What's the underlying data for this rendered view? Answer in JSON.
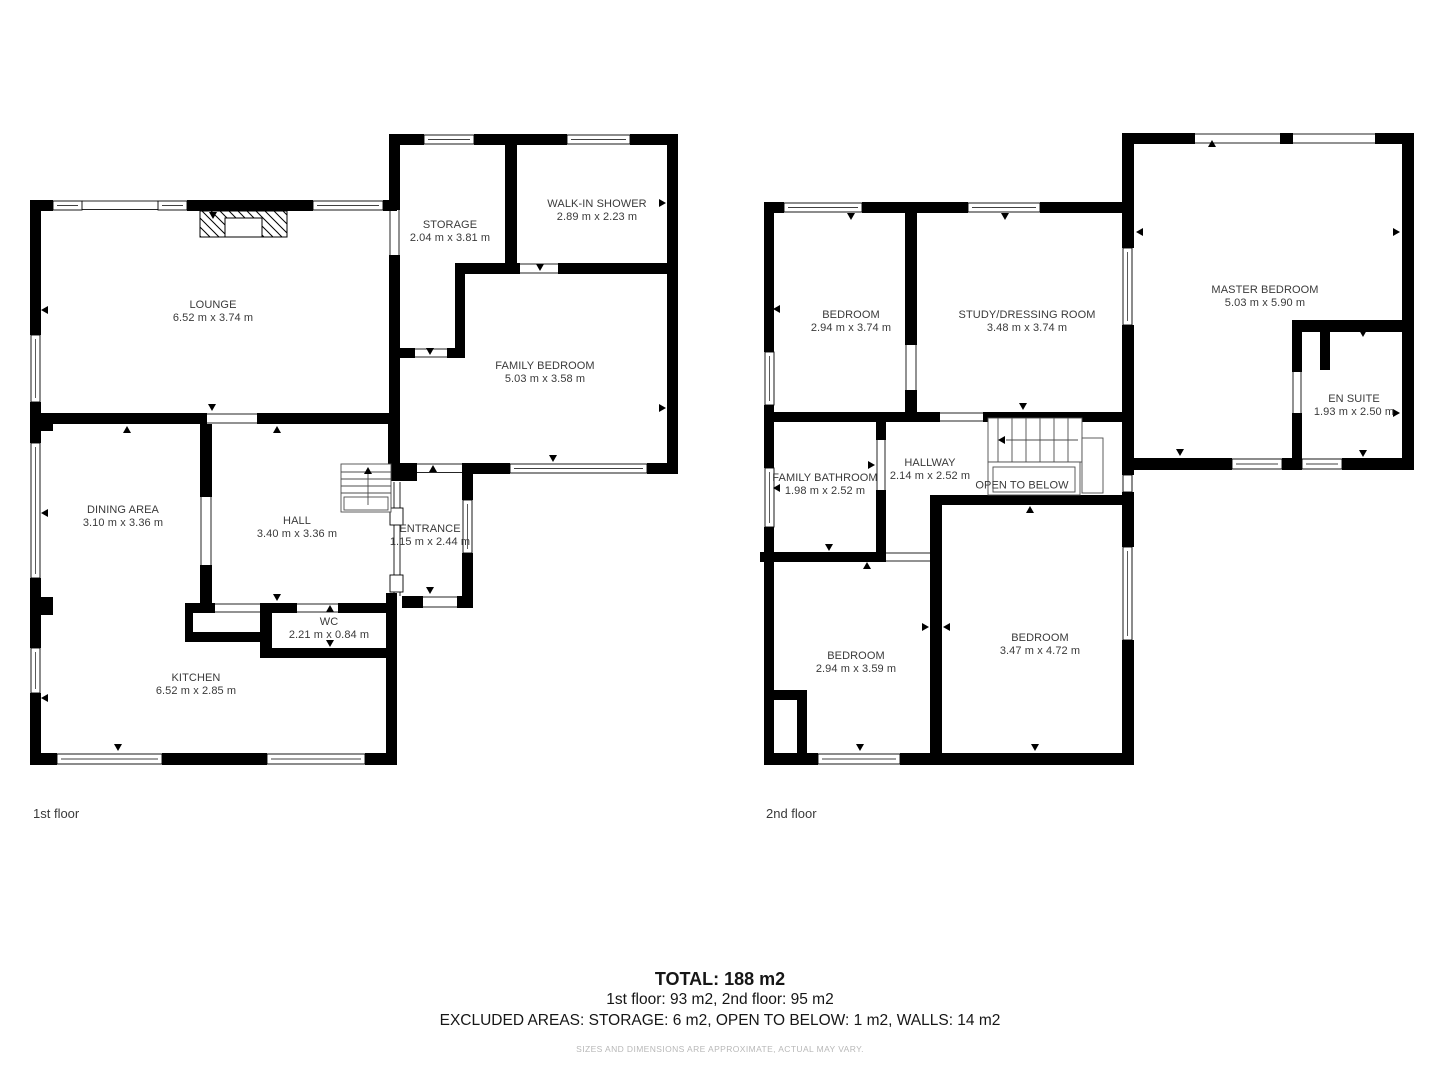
{
  "floors": [
    {
      "caption": "1st floor",
      "caption_x": 33,
      "caption_y": 806,
      "rooms": [
        {
          "name": "LOUNGE",
          "dims": "6.52 m x 3.74 m",
          "x": 213,
          "y": 312
        },
        {
          "name": "STORAGE",
          "dims": "2.04 m x 3.81 m",
          "x": 450,
          "y": 232
        },
        {
          "name": "WALK-IN SHOWER",
          "dims": "2.89 m x 2.23 m",
          "x": 597,
          "y": 211
        },
        {
          "name": "FAMILY BEDROOM",
          "dims": "5.03 m x 3.58 m",
          "x": 545,
          "y": 373
        },
        {
          "name": "DINING AREA",
          "dims": "3.10 m x 3.36 m",
          "x": 123,
          "y": 517
        },
        {
          "name": "HALL",
          "dims": "3.40 m x 3.36 m",
          "x": 297,
          "y": 528
        },
        {
          "name": "ENTRANCE",
          "dims": "1.15 m x 2.44 m",
          "x": 430,
          "y": 536
        },
        {
          "name": "WC",
          "dims": "2.21 m x 0.84 m",
          "x": 329,
          "y": 629
        },
        {
          "name": "KITCHEN",
          "dims": "6.52 m x 2.85 m",
          "x": 196,
          "y": 685
        }
      ]
    },
    {
      "caption": "2nd floor",
      "caption_x": 766,
      "caption_y": 806,
      "rooms": [
        {
          "name": "BEDROOM",
          "dims": "2.94 m x 3.74 m",
          "x": 851,
          "y": 322
        },
        {
          "name": "STUDY/DRESSING ROOM",
          "dims": "3.48 m x 3.74 m",
          "x": 1027,
          "y": 322
        },
        {
          "name": "MASTER BEDROOM",
          "dims": "5.03 m x 5.90 m",
          "x": 1265,
          "y": 297
        },
        {
          "name": "EN SUITE",
          "dims": "1.93 m x 2.50 m",
          "x": 1354,
          "y": 406
        },
        {
          "name": "FAMILY BATHROOM",
          "dims": "1.98 m x 2.52 m",
          "x": 825,
          "y": 485
        },
        {
          "name": "HALLWAY",
          "dims": "2.14 m x 2.52 m",
          "x": 930,
          "y": 470
        },
        {
          "name": "OPEN TO BELOW",
          "dims": "",
          "x": 1022,
          "y": 486
        },
        {
          "name": "BEDROOM",
          "dims": "2.94 m x 3.59 m",
          "x": 856,
          "y": 663
        },
        {
          "name": "BEDROOM",
          "dims": "3.47 m x 4.72 m",
          "x": 1040,
          "y": 645
        }
      ]
    }
  ],
  "footer": {
    "total": "TOTAL: 188 m2",
    "floors_line": "1st floor: 93 m2, 2nd floor: 95 m2",
    "excluded_line": "EXCLUDED AREAS: STORAGE: 6 m2, OPEN TO BELOW: 1 m2, WALLS: 14 m2",
    "disclaimer": "SIZES AND DIMENSIONS ARE APPROXIMATE, ACTUAL MAY VARY."
  },
  "colors": {
    "wall": "#000000",
    "label_text": "#3a3a3a",
    "footer_text": "#161616",
    "disclaimer_text": "#b8b8b8"
  }
}
